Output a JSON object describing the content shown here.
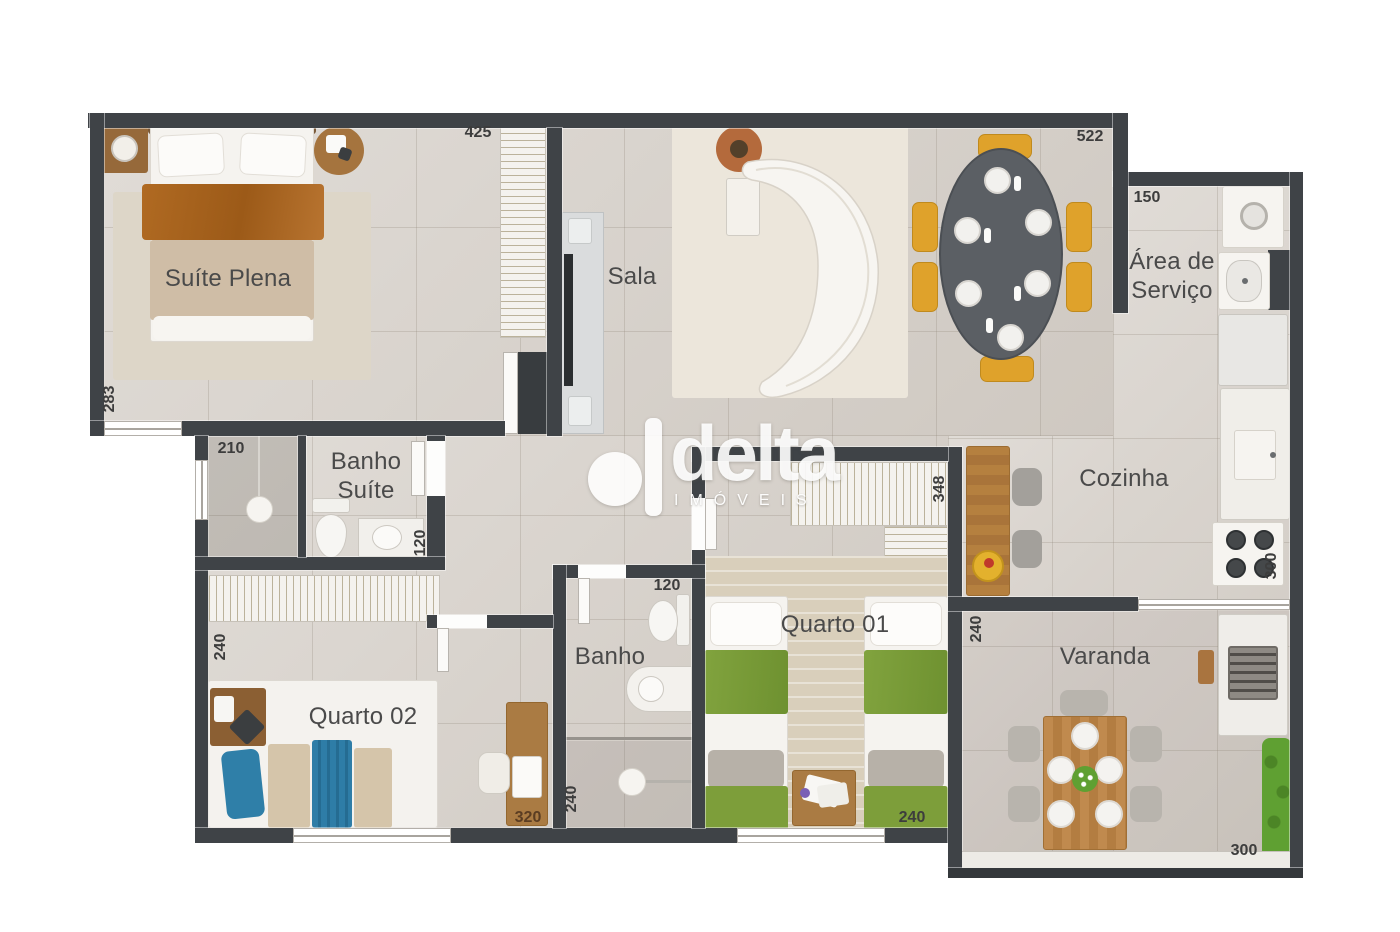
{
  "brand": {
    "wordmark": "delta",
    "subtitle": "IMÓVEIS"
  },
  "rooms": {
    "suite_plena": "Suíte Plena",
    "sala": "Sala",
    "area_servico": "Área de Serviço",
    "banho_suite": "Banho Suíte",
    "cozinha": "Cozinha",
    "quarto_01": "Quarto 01",
    "quarto_02": "Quarto 02",
    "banho": "Banho",
    "varanda": "Varanda"
  },
  "dimensions_cm": {
    "suite_top": "425",
    "sala_top": "522",
    "servico_top": "150",
    "suite_left": "283",
    "banho_suite_top": "210",
    "banho_suite_right": "120",
    "quarto02_left": "240",
    "quarto02_bottom": "320",
    "banho_left": "240",
    "banho_top": "120",
    "quarto01_right": "348",
    "quarto01_bottom": "240",
    "varanda_left": "240",
    "cozinha_right": "300",
    "varanda_bottom": "300"
  },
  "palette": {
    "wall": "#3f4347",
    "floor": "#d6d0c9",
    "wood": "#b5803f",
    "bed_orange": "#b06a22",
    "chair_yellow": "#dfa22b",
    "bedding_green": "#81a33e",
    "bedding_blue": "#2f7fa8",
    "plant_green": "#5fa032",
    "label_text": "#4a4a4a",
    "watermark": "#ffffff"
  }
}
